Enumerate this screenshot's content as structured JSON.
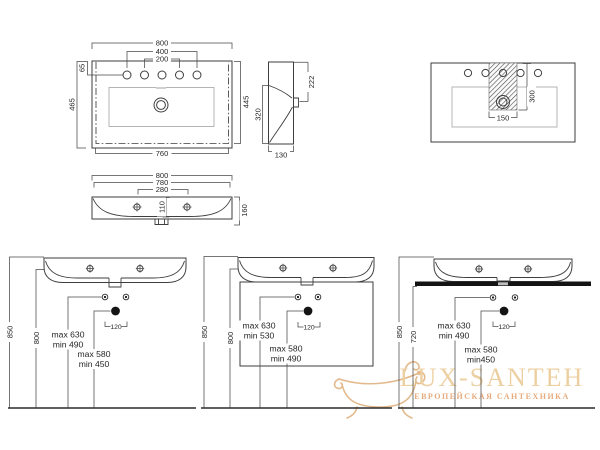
{
  "plan": {
    "d800": "800",
    "d400": "400",
    "d200": "200",
    "d65": "65",
    "d465": "465",
    "d445": "445",
    "d760": "760"
  },
  "side": {
    "d222": "222",
    "d320": "320",
    "d130": "130"
  },
  "cutout": {
    "d300": "300",
    "d150": "150"
  },
  "front": {
    "d800": "800",
    "d780": "780",
    "d280": "280",
    "d110": "110",
    "d160": "160"
  },
  "install_wall": {
    "d850": "850",
    "d800": "800",
    "supply_max": "max 630",
    "supply_min": "min 490",
    "drain_max": "max 580",
    "drain_min": "min 450",
    "d120": "120"
  },
  "install_cabinet": {
    "d850": "850",
    "d800": "800",
    "supply_max": "max 630",
    "supply_min": "min 530",
    "drain_max": "max 580",
    "drain_min": "min 490",
    "d120": "120"
  },
  "install_counter": {
    "d850": "850",
    "d720": "720",
    "supply_max": "max 630",
    "supply_min": "min 490",
    "drain_max": "max 580",
    "drain_min": "min450",
    "d120": "120"
  },
  "watermark": {
    "title": "LUX-SANTEH",
    "subtitle": "ЕВРОПЕЙСКАЯ САНТЕХНИКА"
  },
  "colors": {
    "line": "#3e3e3e",
    "gold_title": "#ecd0a2",
    "gold_subtitle": "#e7ab7e",
    "counter_black": "#141414"
  }
}
